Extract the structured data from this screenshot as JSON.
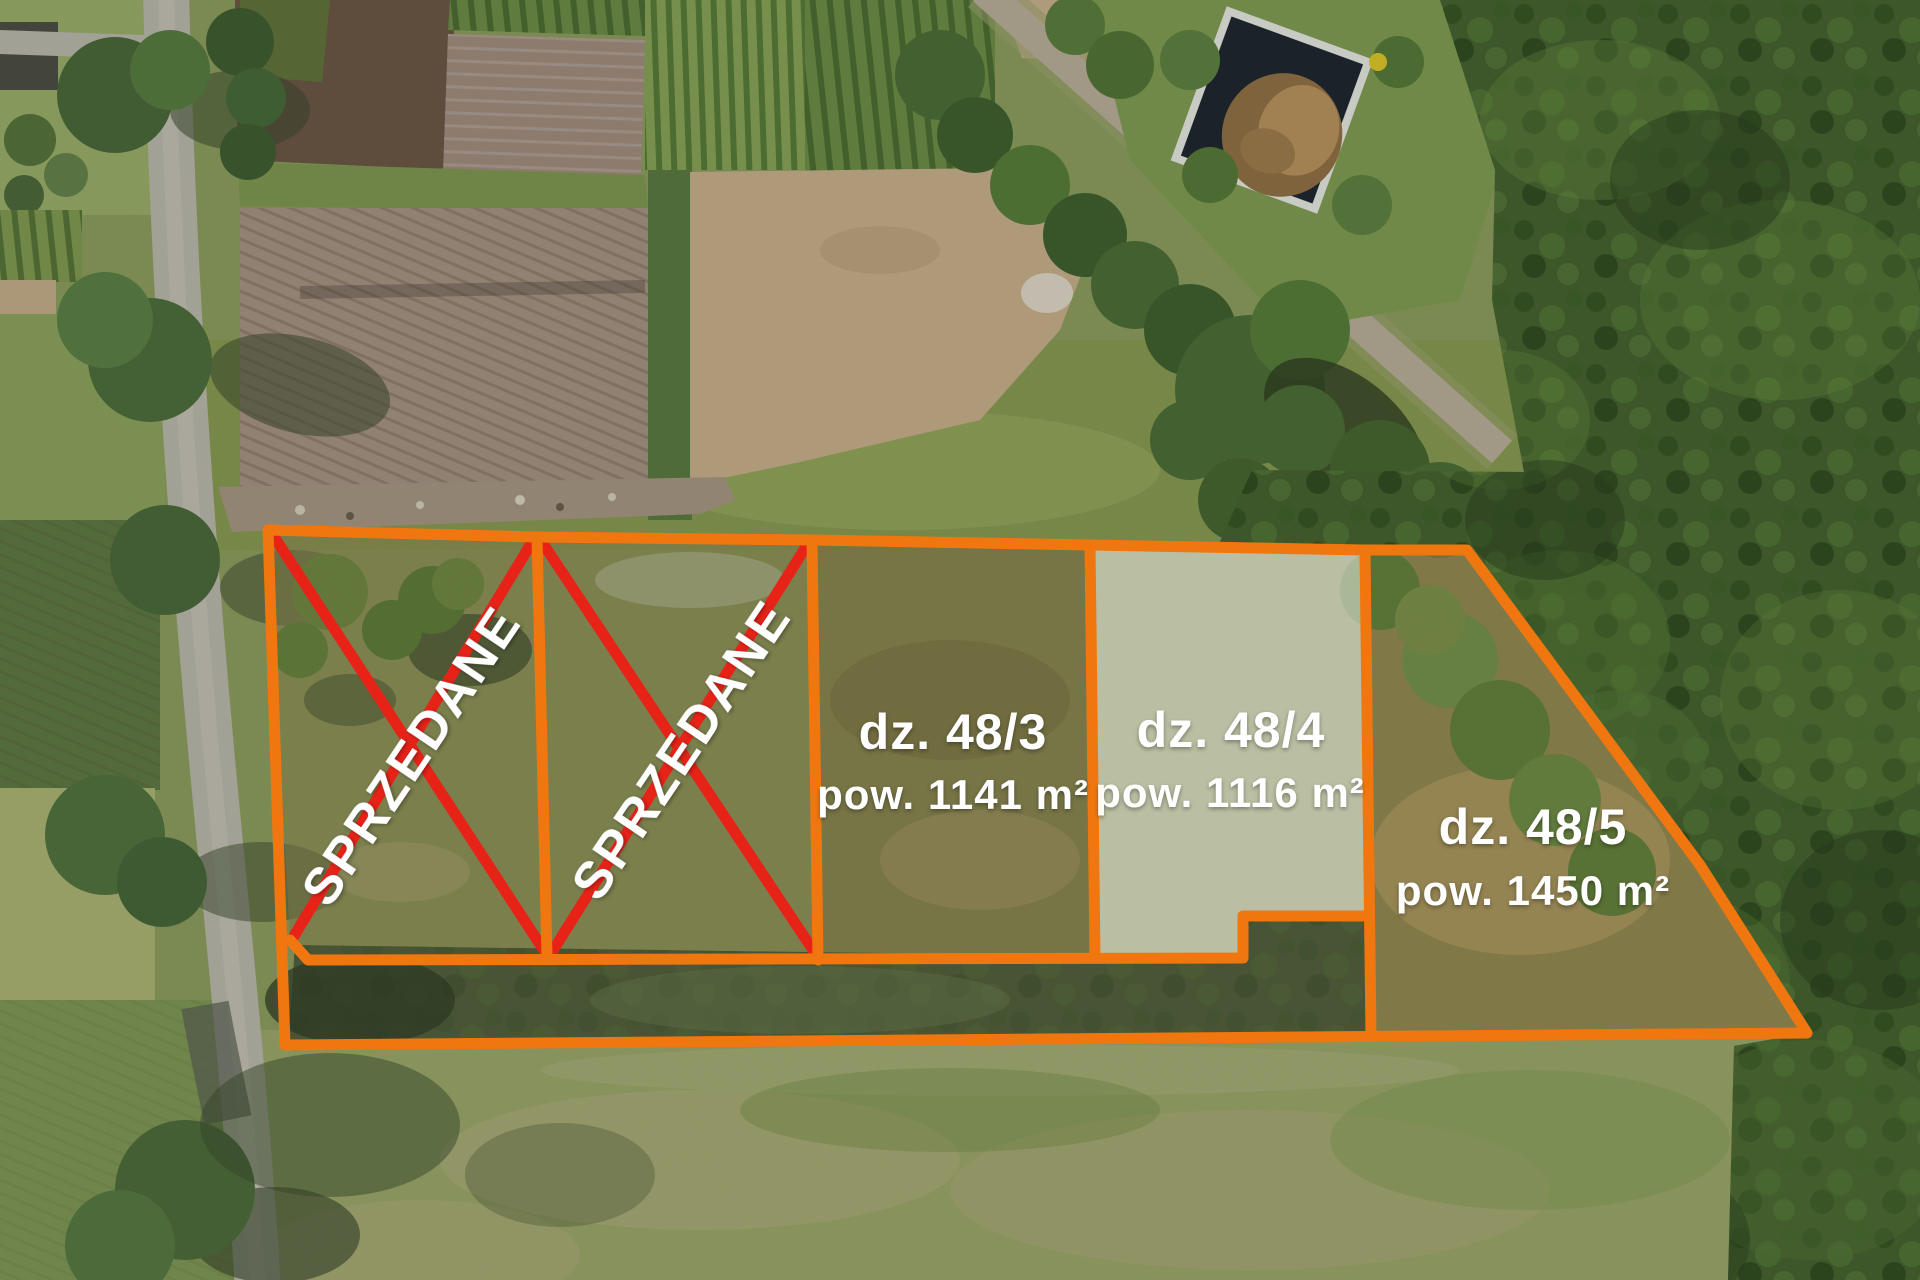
{
  "overlay": {
    "boundary_color": "#f0770f",
    "sold_cross_color": "#e72318",
    "label_color": "#ffffff",
    "highlight_fill": "rgba(238,242,233,0.55)",
    "plots": [
      {
        "label": "SPRZEDANE",
        "status": "sold"
      },
      {
        "label": "SPRZEDANE",
        "status": "sold"
      },
      {
        "parcel": "dz. 48/3",
        "area": "pow. 1141 m²",
        "status": "for-sale"
      },
      {
        "parcel": "dz. 48/4",
        "area": "pow. 1116 m²",
        "status": "for-sale",
        "highlighted": true
      },
      {
        "parcel": "dz. 48/5",
        "area": "pow. 1450 m²",
        "status": "for-sale"
      }
    ]
  }
}
